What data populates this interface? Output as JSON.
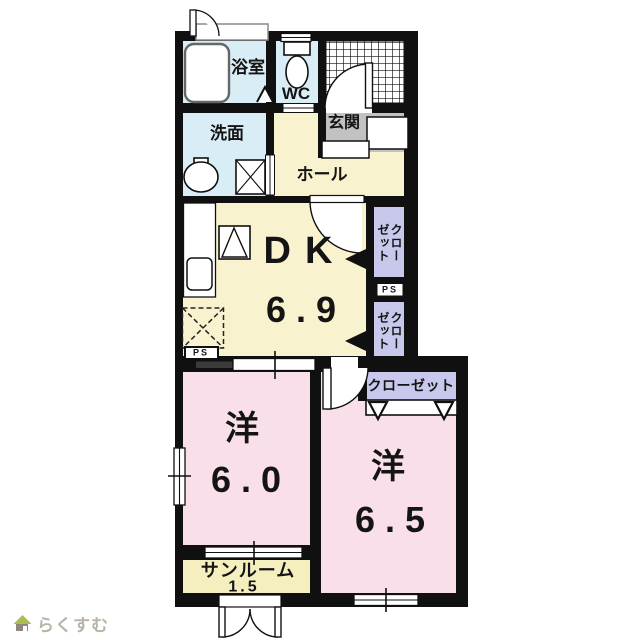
{
  "meta": {
    "type": "japanese-apartment-floor-plan"
  },
  "rooms": {
    "bathroom": {
      "label": "浴室"
    },
    "toilet": {
      "label": "WC"
    },
    "washroom": {
      "label": "洗面"
    },
    "hall": {
      "label": "ホール"
    },
    "entrance": {
      "label": "玄関"
    },
    "dining_kitchen": {
      "label": "DK",
      "size": "6.9"
    },
    "closet_upper": {
      "left_column": "ゼット",
      "right_column": "クロー"
    },
    "closet_lower": {
      "left_column": "ゼット",
      "right_column": "クロー"
    },
    "pipe_space_right": {
      "label": "PS"
    },
    "pipe_space_left": {
      "label": "PS"
    },
    "western_room_1": {
      "label": "洋",
      "size": "6.0"
    },
    "western_room_2": {
      "label": "洋",
      "size": "6.5"
    },
    "closet_bedroom2": {
      "label": "クローゼット"
    },
    "sunroom": {
      "label": "サンルーム",
      "size": "1.5"
    }
  },
  "logo": {
    "text": "らくすむ"
  },
  "colors": {
    "wall": "#101010",
    "wet_area_blue": "#d9edf6",
    "hall_dk_cream": "#f8f2ce",
    "entrance_gray": "#c2c2c2",
    "closet_lavender": "#c8c8ec",
    "bedroom_pink": "#f9dfe9",
    "sunroom_yellow": "#f5efc0",
    "logo_text": "#b9b3a8",
    "logo_roof_green": "#a9bf50"
  }
}
